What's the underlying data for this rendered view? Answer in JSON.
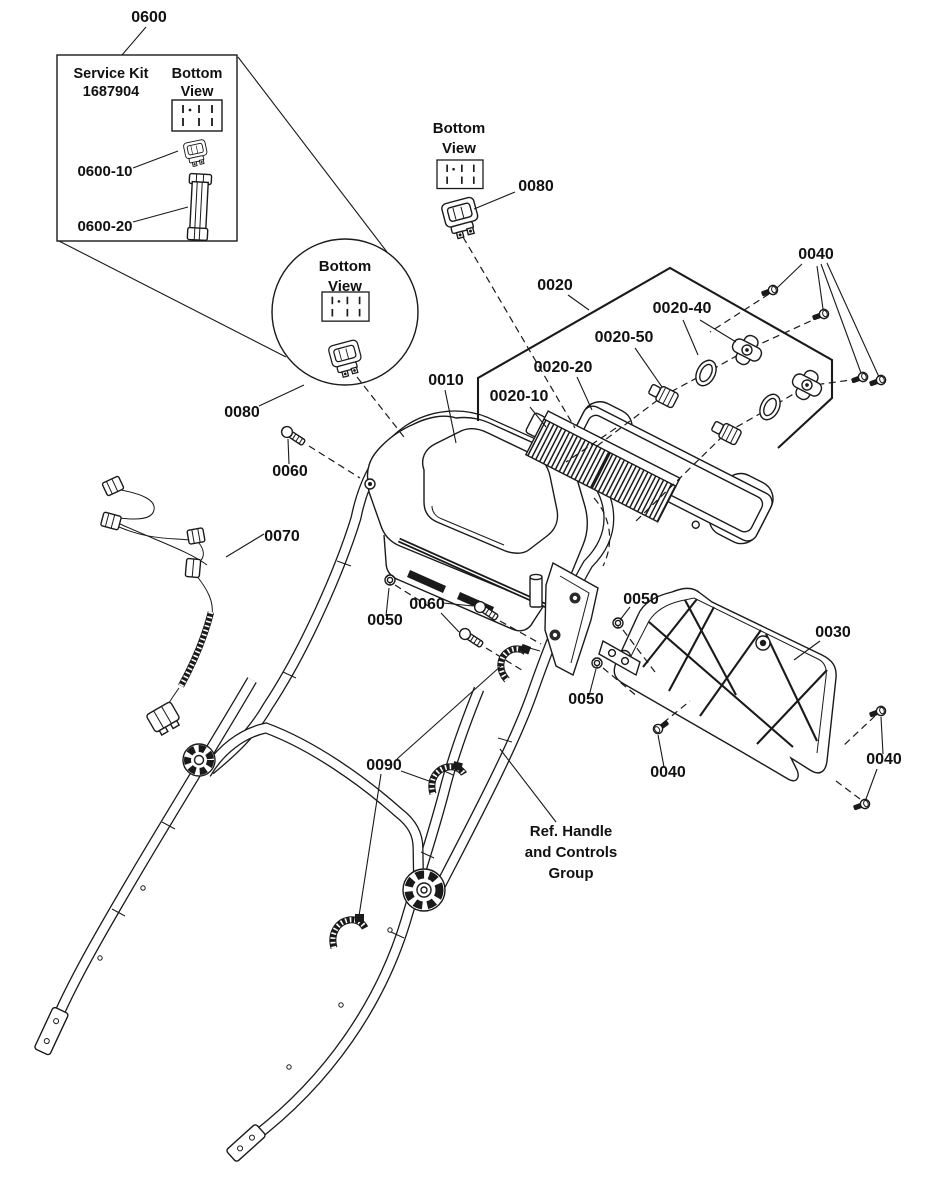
{
  "diagram": {
    "callouts": {
      "n0600": "0600",
      "n0600_10": "0600-10",
      "n0600_20": "0600-20",
      "n0080_circle": "0080",
      "n0080_top": "0080",
      "n0010": "0010",
      "n0020": "0020",
      "n0020_10": "0020-10",
      "n0020_20": "0020-20",
      "n0020_40": "0020-40",
      "n0020_50": "0020-50",
      "n0030": "0030",
      "n0040_top": "0040",
      "n0040_bottom_left": "0040",
      "n0040_bottom_right": "0040",
      "n0050_left": "0050",
      "n0050_mid": "0050",
      "n0050_lower": "0050",
      "n0060_upper": "0060",
      "n0060_mid": "0060",
      "n0070": "0070",
      "n0090": "0090"
    },
    "service_kit": {
      "title": "Service Kit",
      "part_number": "1687904",
      "view_line1": "Bottom",
      "view_line2": "View"
    },
    "detail_circle": {
      "view_line1": "Bottom",
      "view_line2": "View"
    },
    "top_view": {
      "view_line1": "Bottom",
      "view_line2": "View"
    },
    "reference_note": {
      "line1": "Ref. Handle",
      "line2": "and Controls",
      "line3": "Group"
    }
  }
}
